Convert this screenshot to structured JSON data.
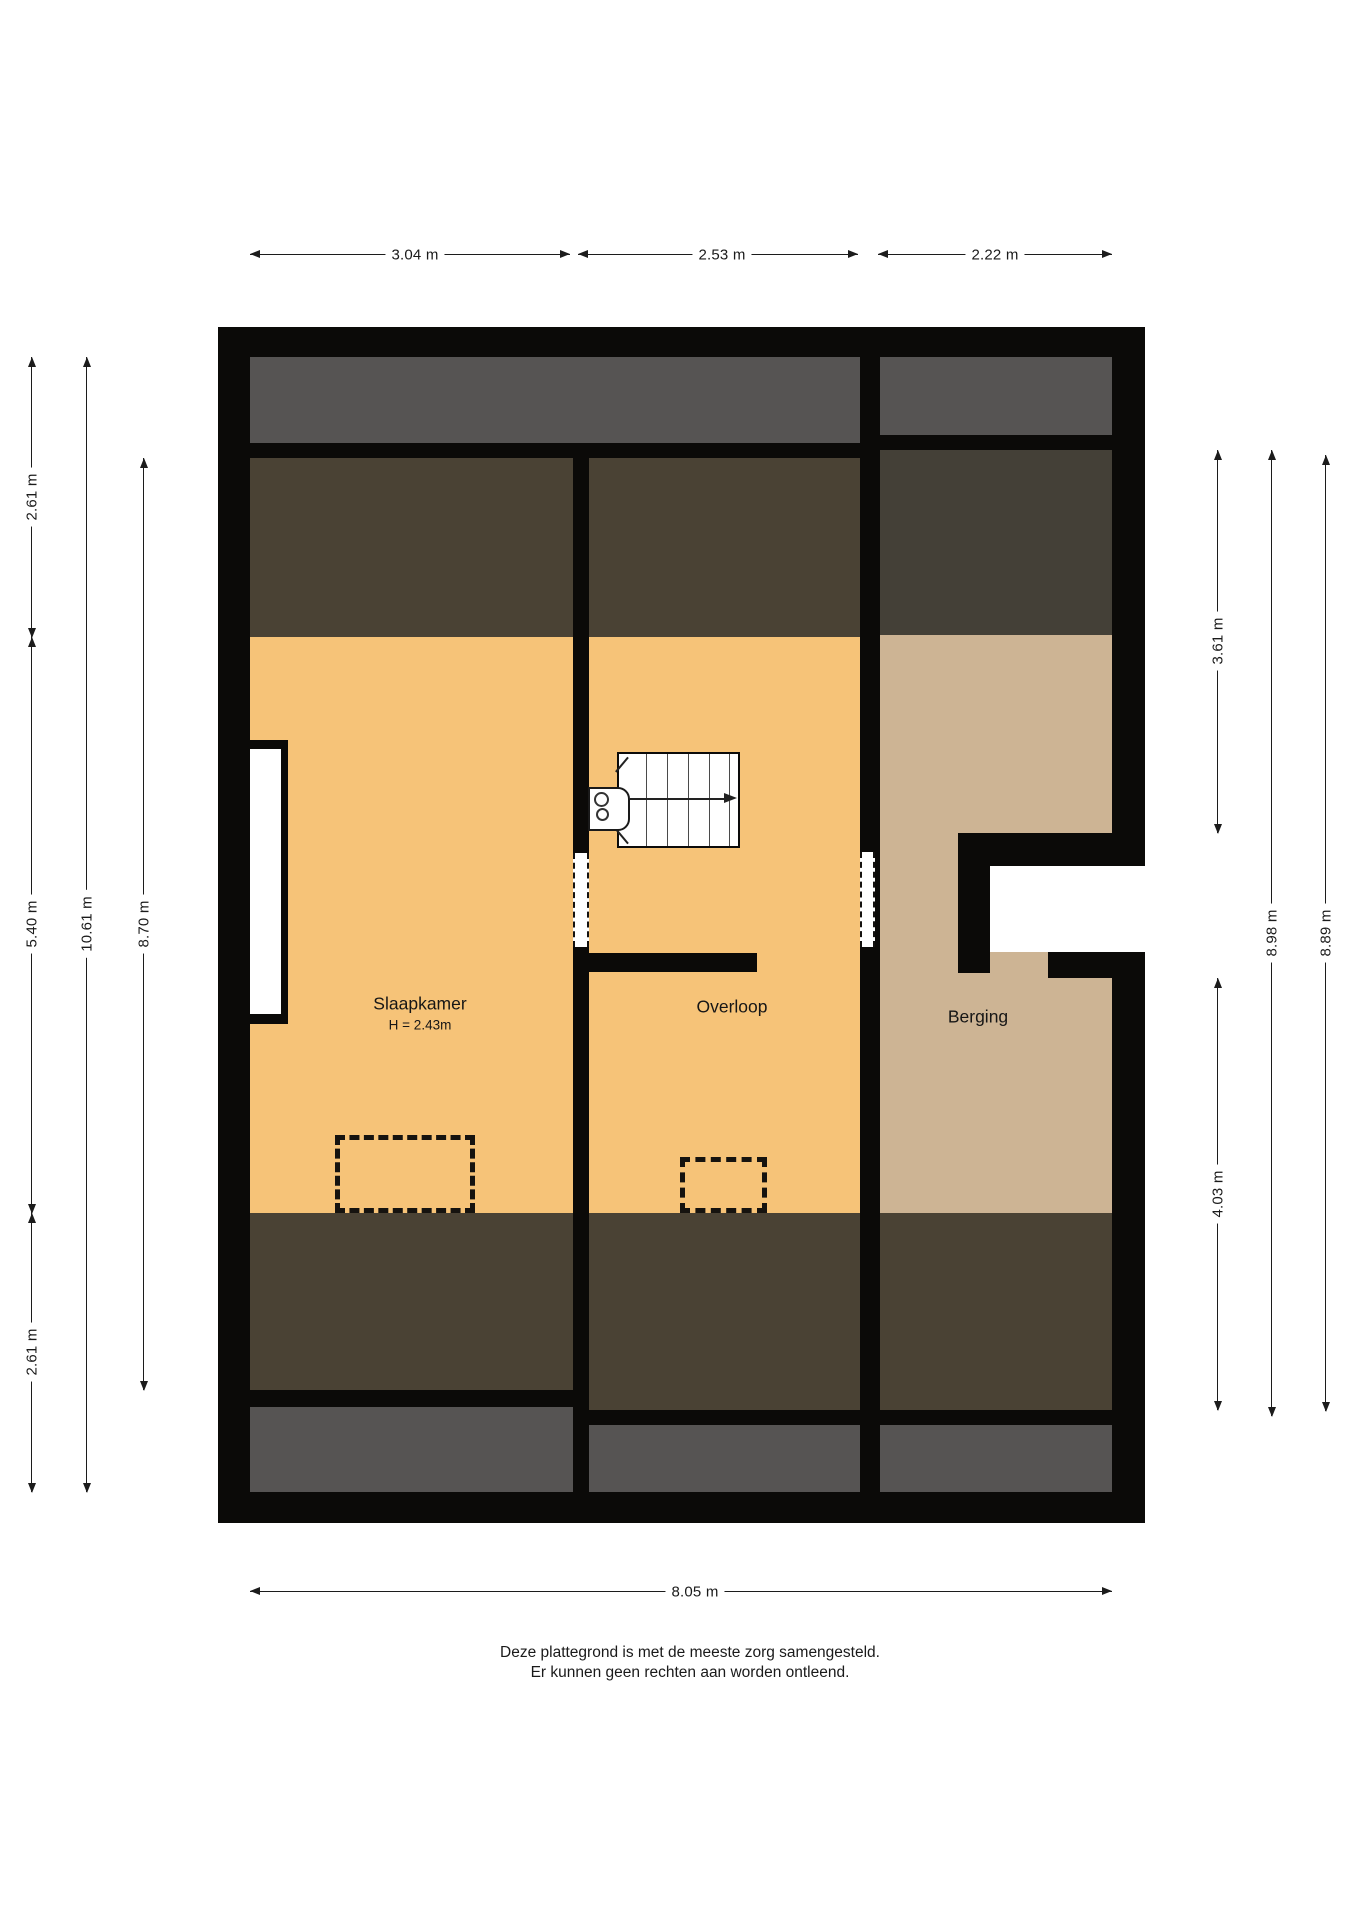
{
  "colors": {
    "wall": "#0b0a08",
    "floor_orange": "#f6c378",
    "floor_tan": "#cdb494",
    "roof_gray": "#565453",
    "roof_brown": "#4a4234",
    "roof_brown_dark": "#444037",
    "dim": "#1c1c1c",
    "text": "#1a1a1a"
  },
  "rooms": {
    "slaapkamer": {
      "name": "Slaapkamer",
      "height_note": "H = 2.43m"
    },
    "overloop": {
      "name": "Overloop"
    },
    "berging": {
      "name": "Berging"
    }
  },
  "dims": {
    "top": [
      "3.04 m",
      "2.53 m",
      "2.22 m"
    ],
    "bottom": "8.05 m",
    "left_outer_top": "2.61 m",
    "left_outer_mid": "5.40 m",
    "left_outer_bottom": "2.61 m",
    "left_total": "10.61 m",
    "left_inner": "8.70 m",
    "right_upper": "3.61 m",
    "right_lower": "4.03 m",
    "right_total_1": "8.98 m",
    "right_total_2": "8.89 m"
  },
  "footer": {
    "line1": "Deze plattegrond is met de meeste zorg samengesteld.",
    "line2": "Er kunnen geen rechten aan worden ontleend."
  }
}
